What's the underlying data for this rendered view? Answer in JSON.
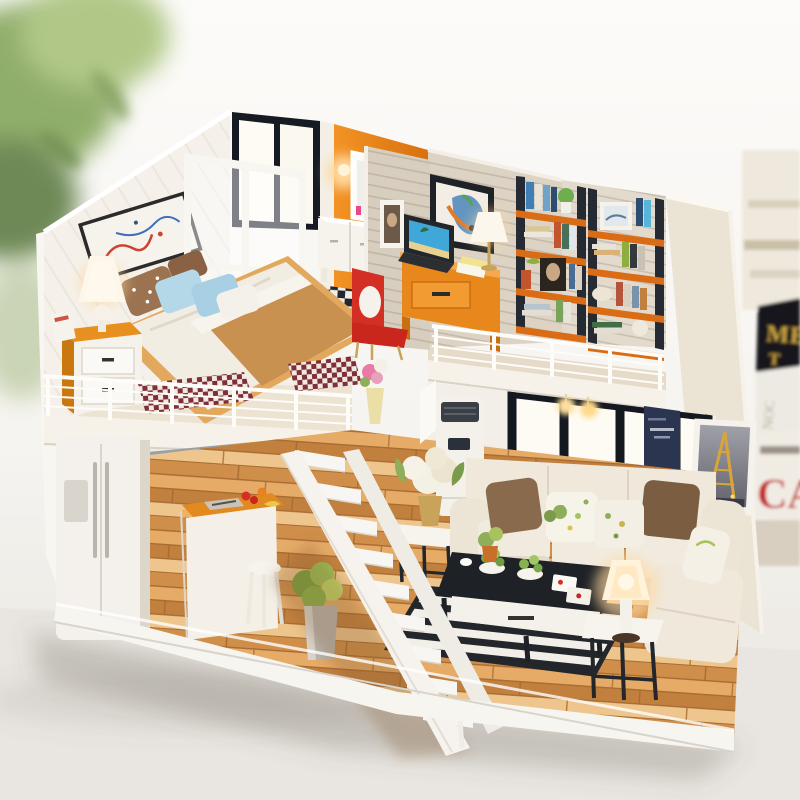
{
  "scene": {
    "type": "photograph",
    "subject": "DIY miniature dollhouse: a two-story open loft interior displayed on a white table",
    "view": "three-quarter front view, no roof, open front",
    "background": [
      "blurred green houseplant foliage at top-left",
      "blurred full-size book spines along right edge",
      "bright white wall"
    ]
  },
  "background_books": {
    "black_spine_line1": "ME",
    "black_spine_line2": "T",
    "pale_spine_text": "NOC",
    "red_spine_text": "CA"
  },
  "palette": {
    "wall_white": "#f5f1ea",
    "accent_orange": "#e8851f",
    "shelf_orange": "#d96c15",
    "wood_floor": "#d89a55",
    "loft_floor": "#ece3d2",
    "sofa_cream": "#efe8db",
    "chair_red": "#d42f25",
    "table_black": "#1e2126",
    "lamp_glow": "#ffd9a0",
    "blanket_camel": "#c8914f",
    "pillow_blue": "#aed4e8",
    "pillow_brown": "#8a6a4d",
    "checker_dark": "#23262b",
    "rug_maroon": "#7e2f3c",
    "book_gold": "#c9a23f",
    "red_letters": "#c21f1f",
    "foliage_green": "#7ca05a"
  },
  "dollhouse": {
    "upper_floor": {
      "bedroom": [
        "double bed with white duvet and camel throw",
        "polka-dot and blue pillows",
        "orange nightstand with white drawers",
        "white table lamp (lit)",
        "abstract wall art",
        "white-framed glass partition",
        "maroon houndstooth rugs",
        "white wire loft railing",
        "flower vase at loft edge"
      ],
      "bathroom": [
        "orange wall",
        "black-framed window",
        "white mirror",
        "white vanity cabinet",
        "glowing wall sconce",
        "black & white checkered floor"
      ],
      "study": [
        "wood-plank partition wall with small photo frame",
        "horse painting",
        "laptop with beach wallpaper",
        "orange desk with drawer",
        "desk lamp (lit)",
        "red desk chair",
        "two orange ladder bookshelves full of books",
        "portrait print",
        "potted plant"
      ]
    },
    "lower_floor": {
      "kitchen": [
        "white double-door refrigerator",
        "white cabinets with gray counter",
        "orange-top island with food and cutting board",
        "white stool",
        "leafy plant in metal pot"
      ],
      "living_room": [
        "white standing air conditioner",
        "black-framed picture windows",
        "navy poster",
        "Eiffel Tower framed print",
        "cream corner sofa with brown and floral pillows",
        "black coffee table with white drawer",
        "black & white striped rug",
        "side table with white rose bouquet",
        "end table with lit white lamp",
        "pendant lights under loft",
        "small potted plants and playing cards"
      ],
      "staircase": "white open-riser staircase connecting the floors"
    },
    "structure": [
      "white outer walls",
      "warm wood plank flooring",
      "white display base"
    ]
  }
}
